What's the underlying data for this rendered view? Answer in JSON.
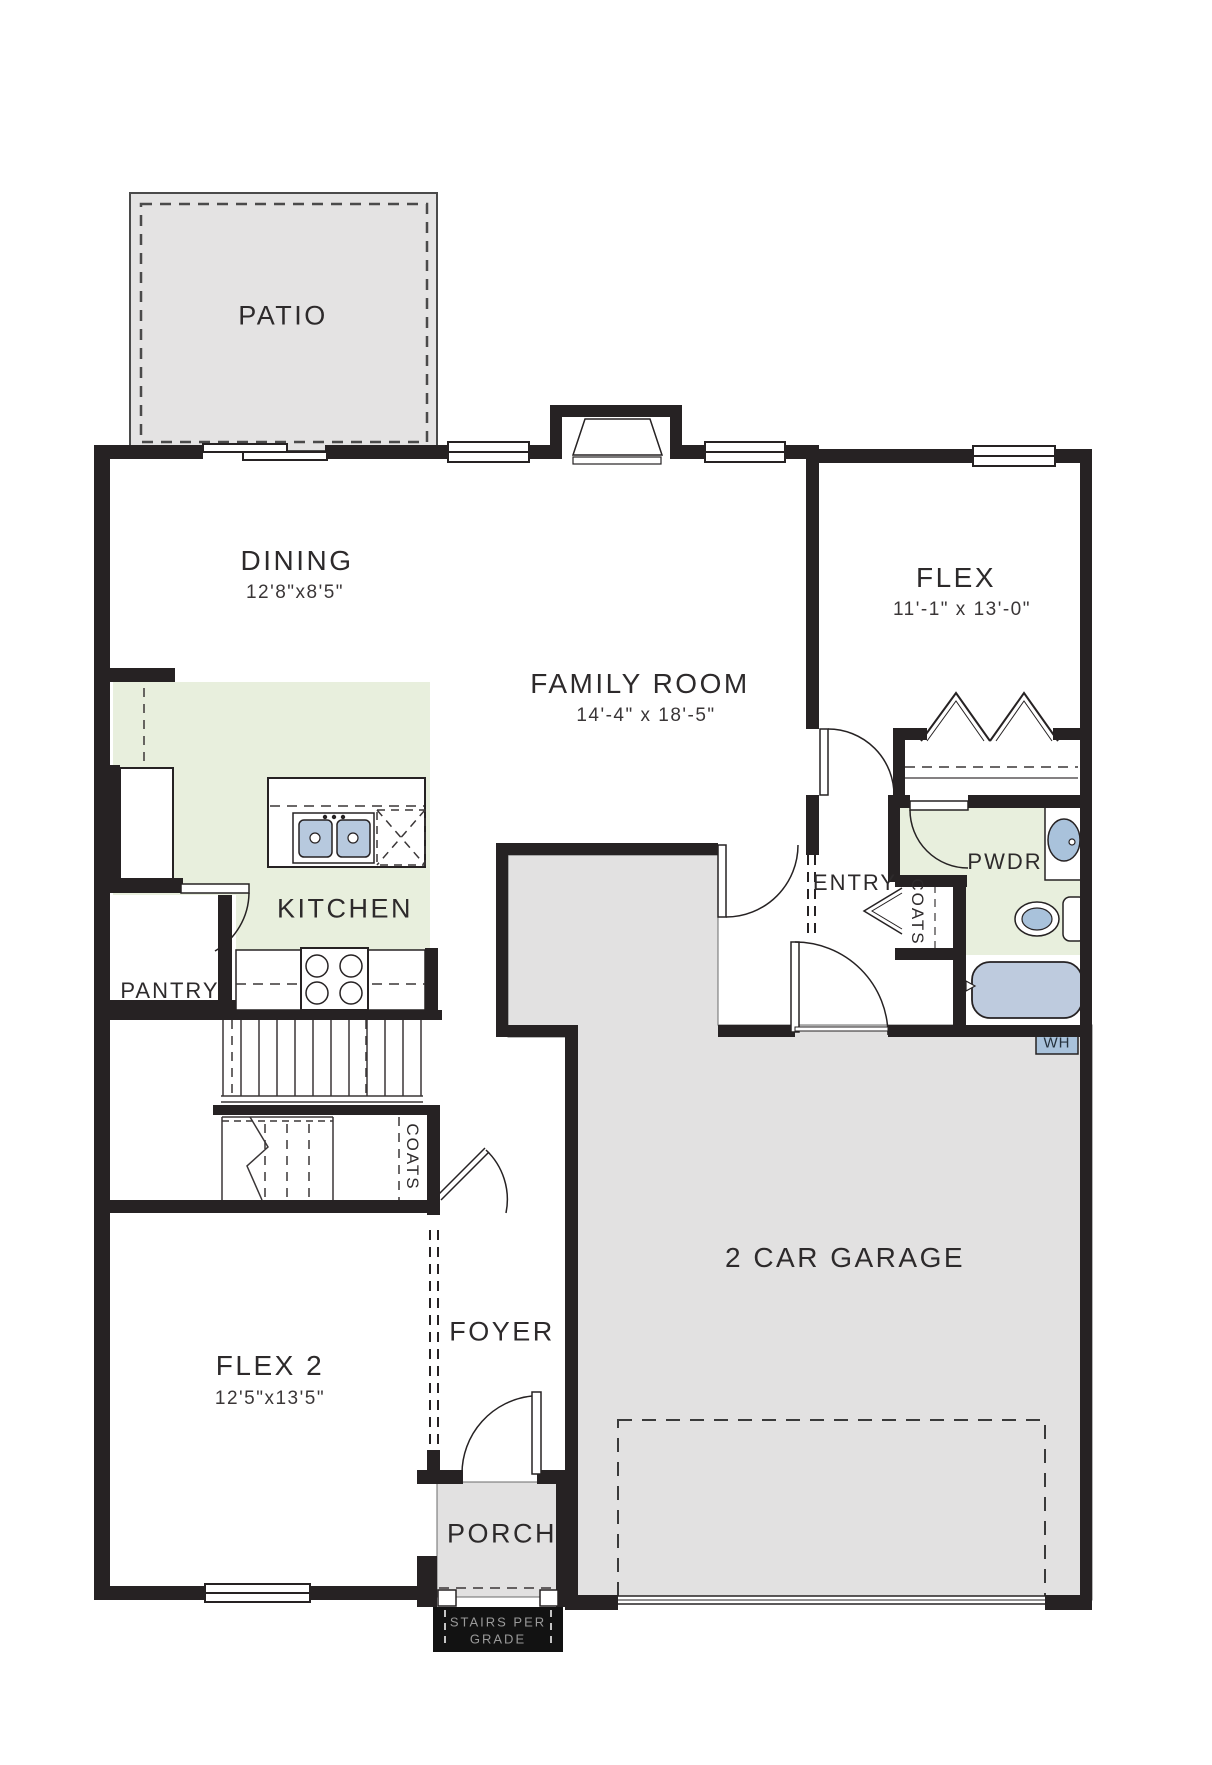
{
  "plan": {
    "title": "First floor plan",
    "colors": {
      "wall": "#262223",
      "room_gray": "#e2e1e1",
      "room_green": "#e8efdd",
      "fixture_blue": "#aec5dc",
      "label_text": "#2d2a2b",
      "note_text": "#9a9a9a"
    },
    "rooms": {
      "patio": {
        "label": "PATIO"
      },
      "dining": {
        "label": "DINING",
        "dims": "12'8\"x8'5\""
      },
      "family_room": {
        "label": "FAMILY ROOM",
        "dims": "14'-4\" x 18'-5\""
      },
      "flex": {
        "label": "FLEX",
        "dims": "11'-1\" x 13'-0\""
      },
      "kitchen": {
        "label": "KITCHEN"
      },
      "pantry": {
        "label": "PANTRY"
      },
      "entry": {
        "label": "ENTRY"
      },
      "coats_entry": {
        "label": "COATS"
      },
      "pwdr": {
        "label": "PWDR"
      },
      "water_heater": {
        "label": "WH"
      },
      "garage": {
        "label": "2 CAR GARAGE"
      },
      "coats_stairs": {
        "label": "COATS"
      },
      "foyer": {
        "label": "FOYER"
      },
      "flex2": {
        "label": "FLEX 2",
        "dims": "12'5\"x13'5\""
      },
      "porch": {
        "label": "PORCH"
      },
      "stairs_note": {
        "line1": "STAIRS PER",
        "line2": "GRADE"
      }
    }
  }
}
